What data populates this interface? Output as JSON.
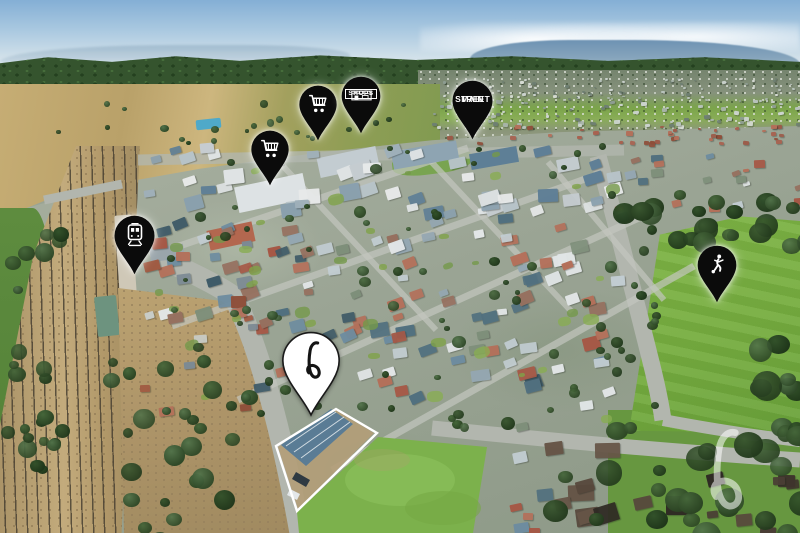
{
  "map_pins": [
    {
      "id": "supermarket-near",
      "icon": "shopping-cart-icon",
      "label": ""
    },
    {
      "id": "supermarket-far",
      "icon": "shopping-cart-icon",
      "label": ""
    },
    {
      "id": "shops",
      "icon": "storefront-icon",
      "label": "SHOPS"
    },
    {
      "id": "main-street",
      "icon": "",
      "label": "MAIN STREET",
      "label_lines": [
        "MAIN",
        "STREET"
      ]
    },
    {
      "id": "train-station",
      "icon": "train-icon",
      "label": ""
    },
    {
      "id": "sports-ground",
      "icon": "soccer-player-icon",
      "label": ""
    },
    {
      "id": "featured-property",
      "icon": "brand-b-logo",
      "label": "",
      "style": "white-pin-with-black-b"
    }
  ],
  "property": {
    "boundary": "white-outline-around-featured-lot"
  },
  "watermark": {
    "icon": "brand-b-logo"
  },
  "colors": {
    "pin_fill": "#0b0b0b",
    "pin_icon": "#ffffff",
    "property_pin_fill": "#ffffff",
    "property_pin_glyph": "#141414",
    "boundary_stroke": "#ffffff",
    "sky": "#a9c8e0",
    "forest": "#35542e",
    "farmland": "#c2a96f",
    "sports_field_green": "#76ad3f",
    "road_gray": "#b2b6ae",
    "rail_gravel": "#b49c70",
    "watermark_white": "rgba(255,255,255,0.55)"
  }
}
